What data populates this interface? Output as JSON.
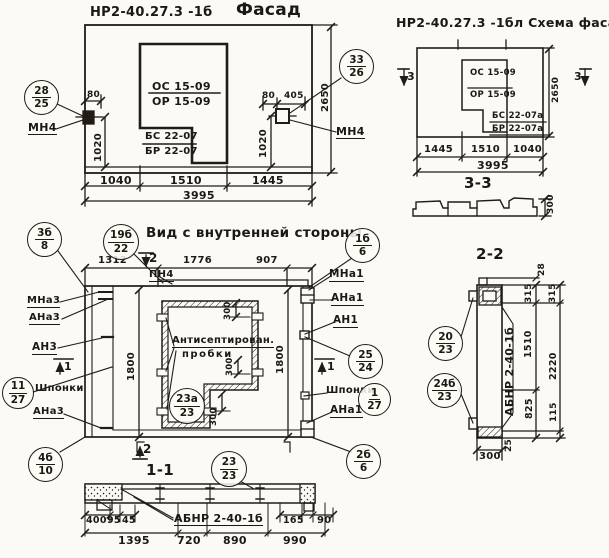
{
  "facade": {
    "title_code": "НР2-40.27.3 -1б",
    "title_word": "Фасад",
    "oc": "ОС 15-09",
    "op": "ОР 15-09",
    "bs": "БС 22-07",
    "br": "БР 22-07",
    "mn4_left": "МН4",
    "mn4_right": "МН4",
    "d80l": "80",
    "d1020l": "1020",
    "d80r": "80",
    "d405": "405",
    "d1020r": "1020",
    "d2650": "2650",
    "d1040": "1040",
    "d1510": "1510",
    "d1445": "1445",
    "d3995": "3995",
    "c28": {
      "top": "28",
      "bot": "25"
    },
    "c33": {
      "top": "33",
      "bot": "26"
    }
  },
  "scheme": {
    "title": "НР2-40.27.3 -1бл Схема фасада",
    "oc": "ОС 15-09",
    "op": "ОР 15-09",
    "bs": "БС 22-07а",
    "br": "БР 22-07а",
    "mark_left": "3",
    "mark_right": "3",
    "d2650": "2650",
    "d1445": "1445",
    "d1510": "1510",
    "d1040": "1040",
    "d3995": "3995",
    "section_label": "3-3",
    "d300": "300"
  },
  "inner": {
    "title": "Вид с внутренней стороны",
    "c19": {
      "top": "19б",
      "bot": "22"
    },
    "c1b": {
      "top": "1б",
      "bot": "6"
    },
    "d1312": "1312",
    "d1776": "1776",
    "d907": "907",
    "mark2_top": "2",
    "pn4": "ПН4",
    "mna3": "МНа3",
    "ana3": "АНа3",
    "an3": "АН3",
    "shponki_left": "Шпонки",
    "ana3_bottom": "АНа3",
    "mark1_left": "1",
    "c3b": {
      "top": "3б",
      "bot": "8"
    },
    "c11": {
      "top": "11",
      "bot": "27"
    },
    "c4b": {
      "top": "4б",
      "bot": "10"
    },
    "mna1": "МНа1",
    "ana1": "АНа1",
    "an1": "АН1",
    "shponki_right": "Шпонки",
    "ana1_bottom": "АНа1",
    "mark1_right": "1",
    "c25": {
      "top": "25",
      "bot": "24"
    },
    "c1_27": {
      "top": "1",
      "bot": "27"
    },
    "c2b": {
      "top": "2б",
      "bot": "6"
    },
    "d1800_left": "1800",
    "d1800_right": "1800",
    "plugs_line1": "Антисептирован.",
    "plugs_line2": "пробки",
    "c23a": {
      "top": "23а",
      "bot": "23"
    },
    "d300_top": "300",
    "d300_mid": "300",
    "d300_bottom": "300",
    "mark2_bottom": "2",
    "section_label": "1-1"
  },
  "sec11": {
    "c23": {
      "top": "23",
      "bot": "23"
    },
    "panel_mark": "АБНР 2-40-1б",
    "d400": "400",
    "d95": "95",
    "d45": "45",
    "d1395": "1395",
    "d720": "720",
    "d890": "890",
    "d165": "165",
    "d90": "90",
    "d990": "990"
  },
  "sec22": {
    "title": "2-2",
    "panel_mark": "АБНР 2-40-1б",
    "c20": {
      "top": "20",
      "bot": "23"
    },
    "c24": {
      "top": "24б",
      "bot": "23"
    },
    "d28": "28",
    "d315_a": "315",
    "d315_b": "315",
    "d1510": "1510",
    "d2220": "2220",
    "d825": "825",
    "d115": "115",
    "d25": "25",
    "d300": "300"
  }
}
